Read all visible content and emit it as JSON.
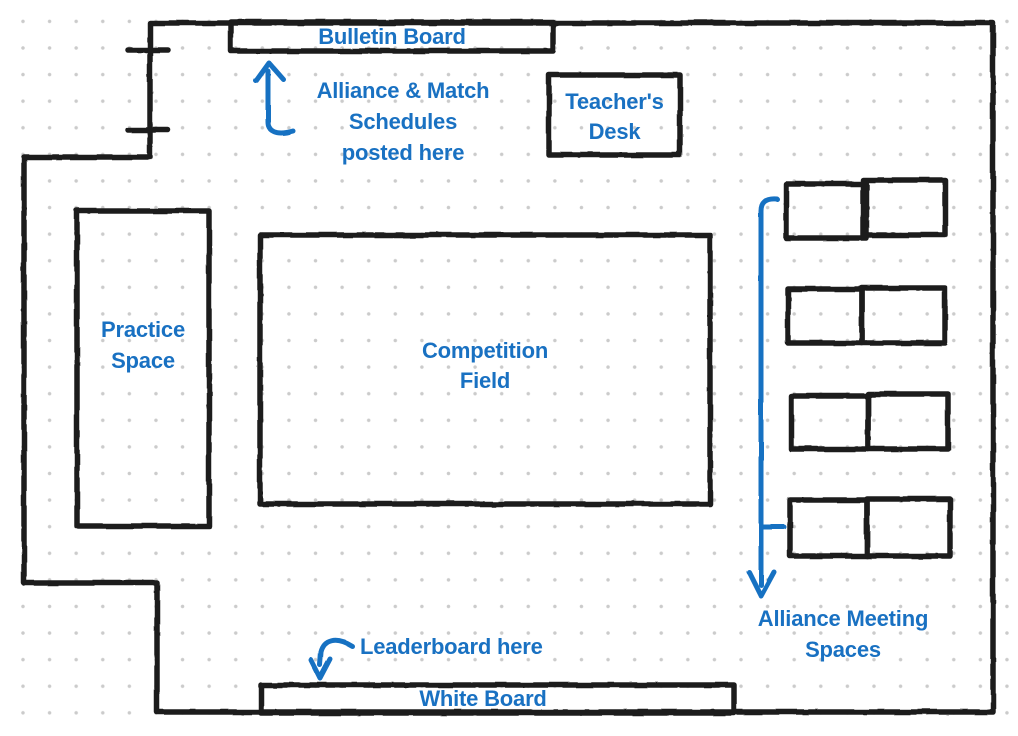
{
  "diagram": {
    "type": "hand-drawn-floor-plan",
    "labels": {
      "bulletin_board": "Bulletin Board",
      "schedules_note": "Alliance & Match\nSchedules\nposted here",
      "teachers_desk": "Teacher's\nDesk",
      "practice_space": "Practice\nSpace",
      "competition_field": "Competition\nField",
      "alliance_meeting_spaces": "Alliance Meeting\nSpaces",
      "leaderboard_note": "Leaderboard here",
      "white_board": "White Board"
    },
    "counts": {
      "alliance_desk_pairs": 4,
      "door_tick_marks": 2
    },
    "colors": {
      "annotation_blue": "#1971c2",
      "wall_black": "#1e1e1e",
      "grid_dot": "#cbcbcb",
      "background": "#ffffff"
    }
  }
}
